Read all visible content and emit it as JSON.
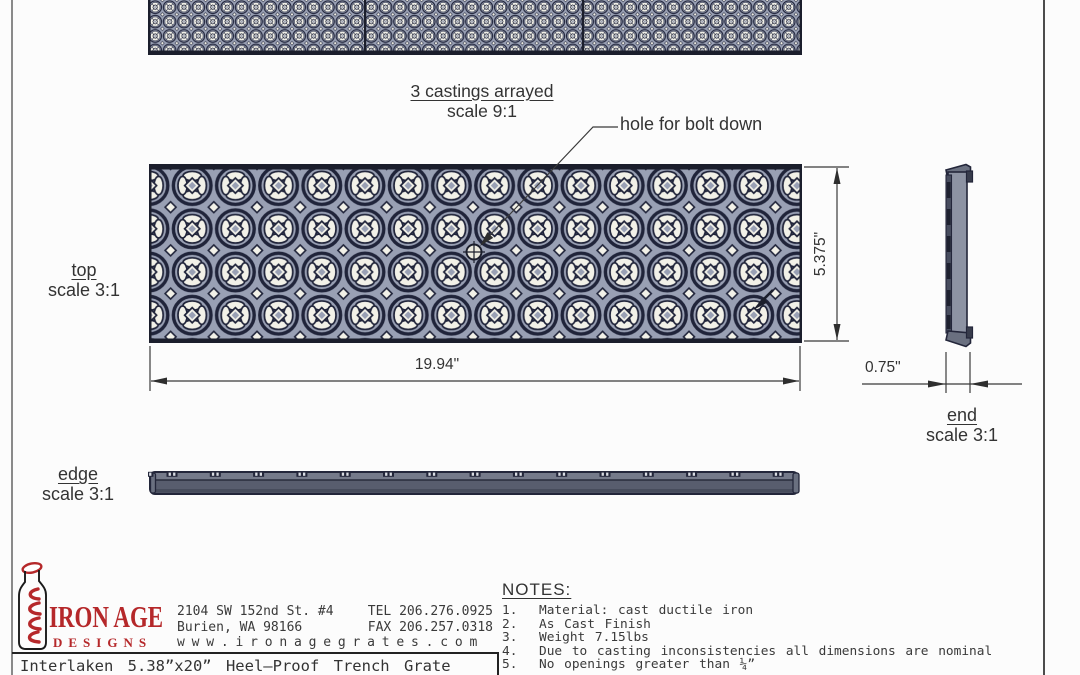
{
  "views": {
    "arrayed": {
      "label": "3 castings arrayed",
      "scale": "scale 9:1"
    },
    "top": {
      "label": "top",
      "scale": "scale 3:1"
    },
    "edge": {
      "label": "edge",
      "scale": "scale 3:1"
    },
    "end": {
      "label": "end",
      "scale": "scale 3:1"
    }
  },
  "annotations": {
    "bolt_hole_label": "hole for bolt down"
  },
  "dimensions": {
    "length": "19.94\"",
    "width": "5.375\"",
    "thickness": "0.75\""
  },
  "title_block": {
    "brand_line1": "IRON AGE",
    "brand_line2": "DESIGNS",
    "address": {
      "street": "2104 SW 152nd St. #4",
      "tel": "TEL 206.276.0925",
      "city": "Burien, WA  98166",
      "fax": "FAX 206.257.0318",
      "website": "www.ironagegrates.com"
    },
    "product_title": "Interlaken 5.38”x20” Heel–Proof Trench Grate"
  },
  "notes": {
    "heading": "NOTES:",
    "items": [
      {
        "num": "1.",
        "text": "Material: cast ductile iron"
      },
      {
        "num": "2.",
        "text": "As Cast Finish"
      },
      {
        "num": "3.",
        "text": "Weight 7.15lbs"
      },
      {
        "num": "4.",
        "text": "Due to casting inconsistencies all dimensions are nominal"
      },
      {
        "num": "5.",
        "text": "No openings greater than ¼”"
      }
    ]
  },
  "colors": {
    "pattern_dark": "#20243a",
    "pattern_field": "#99a0b4",
    "pattern_opening": "#f2f1e8",
    "metal_gray": "#585d6e",
    "brand_red": "#b5282a"
  }
}
